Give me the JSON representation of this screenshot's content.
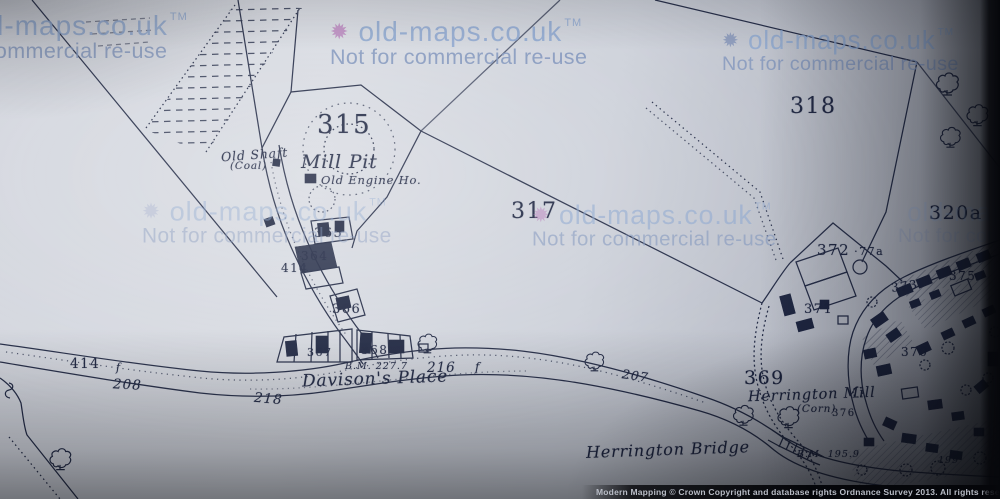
{
  "watermark": {
    "brand": "old-maps.co.uk",
    "trademark": "TM",
    "notice": "Not for commercial re-use",
    "logo_glyph": "✹"
  },
  "copyright_bar": {
    "text": "Modern Mapping © Crown Copyright and database rights Ordnance Survey 2013. All rights reserved"
  },
  "map": {
    "place_labels": {
      "old_shaft": "Old Shaft",
      "old_shaft_detail": "(Coal)",
      "mill_pit": "Mill Pit",
      "old_engine": "Old Engine Ho.",
      "davisons_place": "Davison's Place",
      "herrington_mill": "Herrington Mill",
      "herrington_mill_detail": "(Corn)",
      "herrington_bridge": "Herrington Bridge"
    },
    "benchmarks": {
      "bm_road": "B.M. 227.7",
      "bm_bridge": "B.M. 195.9"
    },
    "parcel_numbers": {
      "p315": "315",
      "p317": "317",
      "p318": "318",
      "p320a": "320a",
      "p364": "364",
      "p365": "365",
      "p366": "366",
      "p367": "367",
      "p368": "368",
      "p369": "369",
      "p370": "370",
      "p371": "371",
      "p372": "372",
      "p372_area": "·77a",
      "p373": "373",
      "p375": "375",
      "p376": "376",
      "p414_terrace": "414",
      "p414_road": "414",
      "p208": "208",
      "p218": "218",
      "p216": "216",
      "p207": "207",
      "p199": "199",
      "f1": "f",
      "f2": "f"
    }
  }
}
